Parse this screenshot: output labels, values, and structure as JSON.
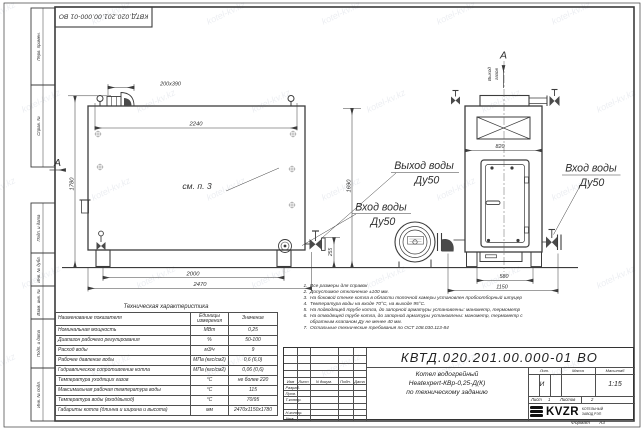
{
  "doc_number": "КВТД.020.201.00.000-01 ВО",
  "watermark": "kotel-kv.kz",
  "frame_columns": {
    "perv_primen": "Перв. примен.",
    "sprav_no": "Справ. №",
    "podp_data1": "Подп. и дата",
    "inv_dubl": "Инв. № дубл.",
    "vzam_inv": "Взам. инв. №",
    "podp_data2": "Подп. и дата",
    "inv_podl": "Инв. № подл."
  },
  "labels": {
    "section_a": "А",
    "see_item": "см. п. 3",
    "gas_out_line1": "Выход",
    "gas_out_line2": "газов",
    "water_out": "Выход воды",
    "water_out_dn": "Ду50",
    "water_in_front": "Вход воды",
    "water_in_front_dn": "Ду50",
    "water_in_side": "Вход воды",
    "water_in_side_dn": "Ду50"
  },
  "dims": {
    "chimney": "200х390",
    "top_width": "2240",
    "height": "1780",
    "mid_height": "1690",
    "legs_span": "2000",
    "total_length": "2470",
    "inlet_height": "255",
    "side_width": "820",
    "side_legs_span": "580",
    "side_total": "1150"
  },
  "tech_table": {
    "title": "Техническая характеристика",
    "headers": [
      "Наименование показателя",
      "Единицы измерения",
      "Значение"
    ],
    "rows": [
      [
        "Номинальная мощность",
        "МВт",
        "0,25"
      ],
      [
        "Диапазон рабочего регулирования",
        "%",
        "50-100"
      ],
      [
        "Расход воды",
        "м3/ч",
        "9"
      ],
      [
        "Рабочее давление воды",
        "МПа (кгс/см2)",
        "0,6 (6,0)"
      ],
      [
        "Гидравлическое сопротивление котла",
        "МПа (кгс/см2)",
        "0,06 (0,6)"
      ],
      [
        "Температура уходящих газов",
        "°С",
        "не более 220"
      ],
      [
        "Максимальная рабочая температура воды",
        "°С",
        "115"
      ],
      [
        "Температура воды (вход/выход)",
        "°С",
        "70/95"
      ],
      [
        "Габариты котла (длинна и ширина и высота)",
        "мм",
        "2470х1150х1780"
      ]
    ]
  },
  "notes": [
    {
      "n": "1.",
      "text": "Все размеры для справок"
    },
    {
      "n": "2.",
      "text": "Допустимое отклонение ±100 мм."
    },
    {
      "n": "3.",
      "text": "На боковой стенке котла в области топочной камеры установлен пробоотборный штуцер"
    },
    {
      "n": "4.",
      "text": "Температура воды на входе 70°С, на выходе 95°С."
    },
    {
      "n": "5.",
      "text": "На подводящей трубе котла, до запорной арматуры установлены: манометр, термометр"
    },
    {
      "n": "6.",
      "text": "На отводящей трубе котла, до запорной арматуры установлены: манометр, термометр с обратным клапаном Ду не менее 40 мм."
    },
    {
      "n": "7.",
      "text": "Остальные технические требования по ОСТ 108.030.113-84"
    }
  ],
  "title_block": {
    "header_cols": {
      "izm": "Изм",
      "list": "Лист",
      "docnum": "N докум.",
      "podp": "Подп.",
      "data": "Дата"
    },
    "rows": {
      "razrab": "Разраб.",
      "prov": "Пров.",
      "tkontr": "Т.контр.",
      "nkontr": "Н.контр.",
      "utv": "Утв."
    },
    "name_line1": "Котел водогрейный",
    "name_line2": "Heatexpert-КВр-0,25-Д(К)",
    "name_line3": "по техническому заданию",
    "lit_label": "Лит.",
    "lit_value": "И",
    "mass_label": "Масса",
    "scale_label": "Масштаб",
    "scale_value": "1:15",
    "sheet_label": "Лист",
    "sheet_value": "1",
    "sheets_label": "Листов",
    "sheets_value": "2",
    "logo_text": "KVZR",
    "company_line1": "КОТЕЛЬНЫЙ",
    "company_line2": "ЗАВОД РЭП",
    "format_label": "Формат",
    "format_value": "А3"
  }
}
